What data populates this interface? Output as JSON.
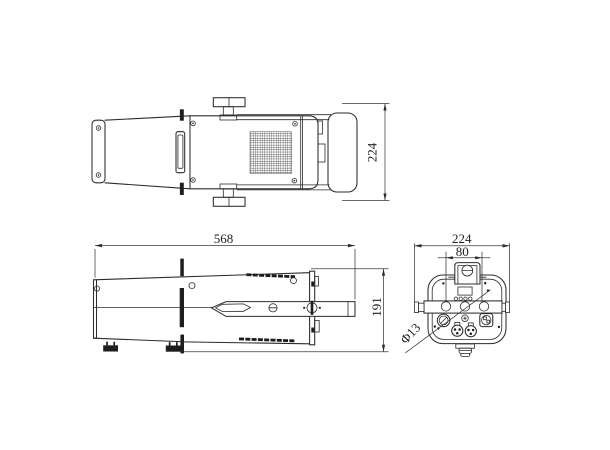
{
  "drawing": {
    "type": "technical-orthographic-drawing",
    "background": "#ffffff",
    "line_color": "#2b2b2b",
    "views": {
      "top": {
        "width_label": "224"
      },
      "side": {
        "length_label": "568",
        "height_label": "191"
      },
      "rear": {
        "width_label": "224",
        "hole_spacing_label": "80",
        "hole_diameter_label": "Φ13"
      }
    }
  }
}
